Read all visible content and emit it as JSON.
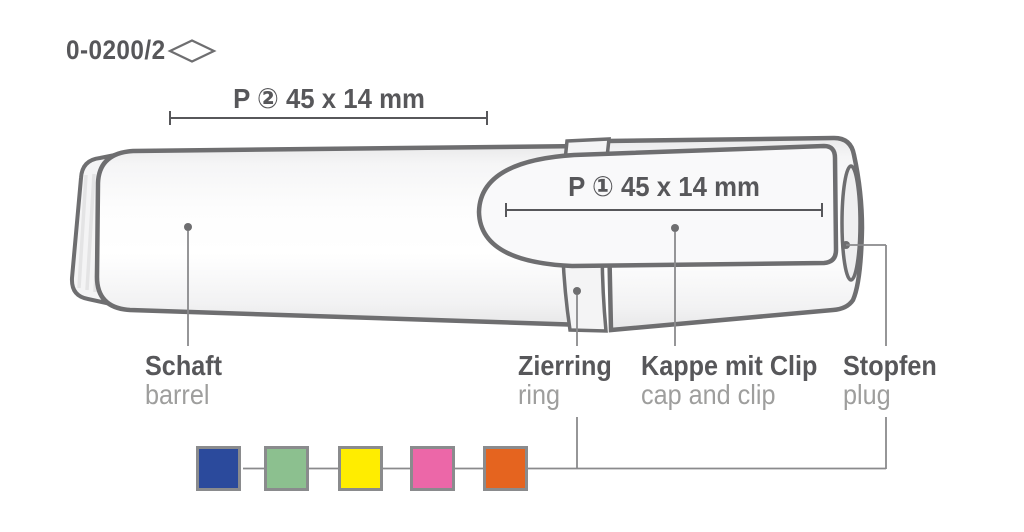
{
  "part_number": "0-0200/2",
  "icons": {
    "diamond": "diamond-outline-icon"
  },
  "print_areas": {
    "barrel": {
      "label": "P ② 45 x 14 mm"
    },
    "clip": {
      "label": "P ① 45 x 14 mm"
    }
  },
  "labels": {
    "barrel": {
      "de": "Schaft",
      "en": "barrel"
    },
    "ring": {
      "de": "Zierring",
      "en": "ring"
    },
    "cap": {
      "de": "Kappe mit Clip",
      "en": "cap and clip"
    },
    "plug": {
      "de": "Stopfen",
      "en": "plug"
    }
  },
  "color_swatches": [
    {
      "name": "blue",
      "hex": "#2b4a9c"
    },
    {
      "name": "green",
      "hex": "#8cc08f"
    },
    {
      "name": "yellow",
      "hex": "#ffed00"
    },
    {
      "name": "pink",
      "hex": "#ec67a8"
    },
    {
      "name": "orange",
      "hex": "#e5641f"
    }
  ],
  "colors": {
    "outline": "#6e6e70",
    "text_primary": "#57575a",
    "text_secondary": "#9e9e9d",
    "leader": "#8a8a8c",
    "swatch_border": "#8a8b8d"
  }
}
